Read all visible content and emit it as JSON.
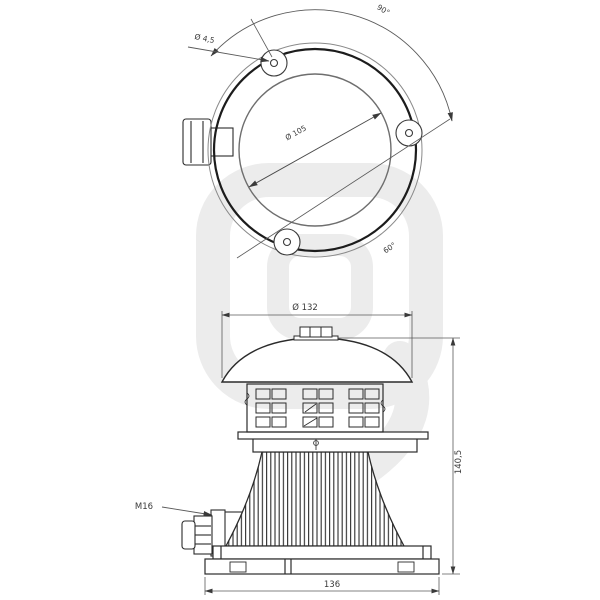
{
  "drawing": {
    "title": "siren-two-view-technical-drawing",
    "top_view": {
      "hole_diameter_label": "Ø 4,5",
      "top_angle_label": "90°",
      "inner_diameter_label": "Ø 105",
      "bottom_angle_label": "60°"
    },
    "side_view": {
      "top_diameter_label": "Ø 132",
      "gland_thread_label": "M16",
      "height_label": "140,5",
      "base_width_label": "136"
    },
    "colors": {
      "line": "#2b2b2b",
      "dim_line": "#5a5a5a",
      "watermark": "#ececec",
      "background": "#ffffff"
    }
  }
}
